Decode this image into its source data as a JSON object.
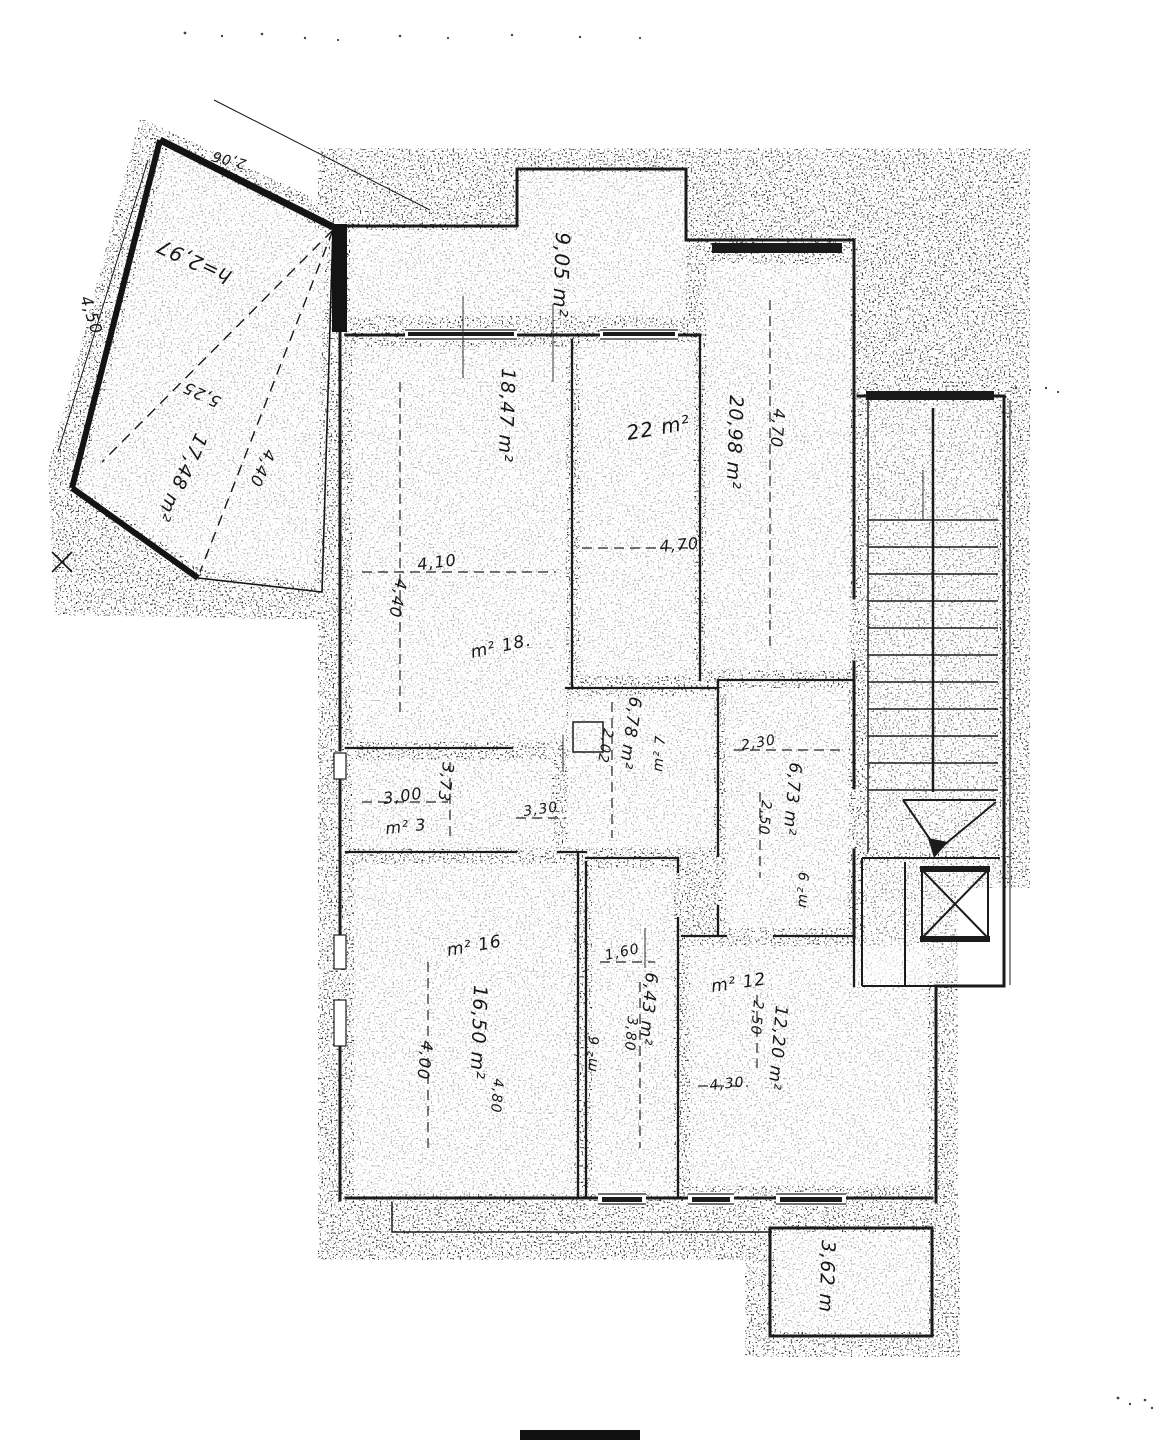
{
  "plan": {
    "terrace": {
      "height_note": "h=2,97",
      "diag_long": "5,25",
      "area": "17,48 m²",
      "diag_short": "4,40",
      "side": "4,50",
      "top_edge": "2,06"
    },
    "balcony_top": {
      "area": "9,05 m²"
    },
    "balcony_bottom": {
      "area": "3,62 m"
    },
    "room_a": {
      "area": "22 m²",
      "width": "4,70"
    },
    "room_b": {
      "area": "20,98 m²",
      "height": "4,70"
    },
    "room_c": {
      "area": "18,47 m²",
      "width": "4,10",
      "height": "4,40",
      "tag": "m² 18."
    },
    "corridor": {
      "tag": "m² 3",
      "width": "3,00",
      "depth": "3,73",
      "width_b": "3,30"
    },
    "room_d": {
      "area": "6,78 m²",
      "tag": "m² 7",
      "depth": "2,02"
    },
    "room_e": {
      "area": "6,73 m²",
      "tag": "m² 9",
      "width": "2,30",
      "depth": "2,50"
    },
    "room_f": {
      "area": "16,50 m²",
      "tag": "m² 16",
      "height": "4,00",
      "dim": "4,80"
    },
    "room_g": {
      "area": "6,43 m²",
      "tag": "m² 6",
      "width": "1,60",
      "depth": "3,80"
    },
    "room_h": {
      "area": "12,20 m²",
      "tag": "m² 12",
      "depth": "2,50",
      "width": "4,30"
    }
  }
}
